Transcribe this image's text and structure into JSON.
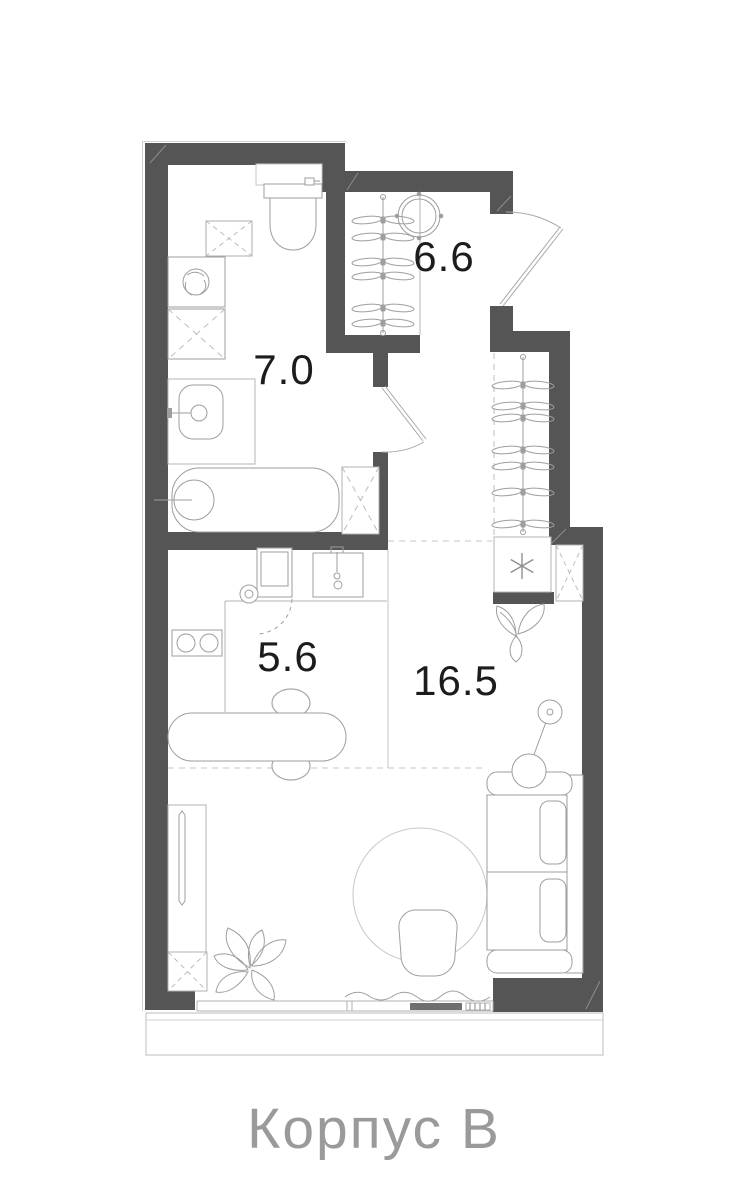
{
  "plan": {
    "caption": "Корпус В",
    "rooms": [
      {
        "key": "hallway",
        "area": "6.6"
      },
      {
        "key": "bathroom",
        "area": "7.0"
      },
      {
        "key": "kitchen",
        "area": "5.6"
      },
      {
        "key": "living_room",
        "area": "16.5"
      }
    ],
    "symbols": {
      "wardrobe_hanger": "propeller-bowtie",
      "ventilation_shaft": "dashed-cross-box",
      "conditioner_star": "six-spoke-asterisk"
    },
    "colors": {
      "wall": "#555555",
      "fixture_line": "#9e9e9e",
      "light_line": "#b5b5b5",
      "label": "#1c1c1c",
      "caption": "#9a9a9a",
      "background": "#ffffff"
    }
  }
}
